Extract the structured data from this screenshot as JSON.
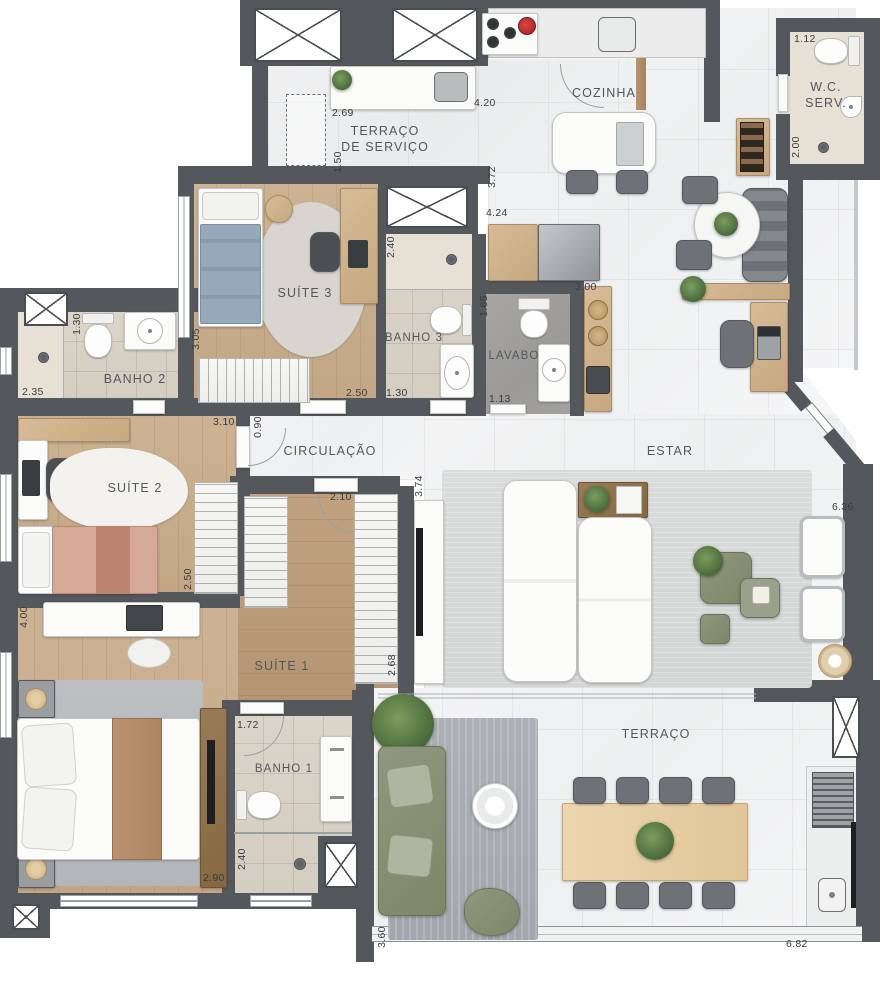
{
  "plan": {
    "type": "apartment-floor-plan",
    "rooms": {
      "terraco_servico": {
        "l1": "TERRAÇO",
        "l2": "DE SERVIÇO"
      },
      "cozinha": {
        "l1": "COZINHA"
      },
      "wc_serv": {
        "l1": "W.C.",
        "l2": "SERV."
      },
      "suite3": {
        "l1": "SUÍTE 3"
      },
      "banho3": {
        "l1": "BANHO 3"
      },
      "lavabo": {
        "l1": "LAVABO"
      },
      "banho2": {
        "l1": "BANHO 2"
      },
      "circulacao": {
        "l1": "CIRCULAÇÃO"
      },
      "estar": {
        "l1": "ESTAR"
      },
      "suite2": {
        "l1": "SUÍTE 2"
      },
      "suite1": {
        "l1": "SUÍTE 1"
      },
      "banho1": {
        "l1": "BANHO 1"
      },
      "terraco": {
        "l1": "TERRAÇO"
      }
    },
    "dims": [
      "2.69",
      "1.50",
      "4.20",
      "3.72",
      "4.24",
      "1.12",
      "2.00",
      "3.05",
      "2.50",
      "2.40",
      "1.30",
      "1.30",
      "2.35",
      "1.65",
      "1.13",
      "3.00",
      "0.90",
      "3.10",
      "2.50",
      "2.10",
      "2.68",
      "3.74",
      "6.36",
      "4.00",
      "2.90",
      "1.72",
      "2.40",
      "3.60",
      "6.82"
    ],
    "colors": {
      "wall": "#54575b",
      "marble_floor": "#f2f3f4",
      "wood_floor": "#c8ad8d",
      "tile_floor": "#d8d1c5",
      "stone_floor": "#a09f9d",
      "rug_living": "#d8dbda",
      "rug_terrace": "#a9aeb5",
      "sofa_green": "#87907a",
      "table_wood": "#d7bc97",
      "accent_bed_blue": "#95a9ba",
      "accent_bed_pink": "#d6a897",
      "accent_runner": "#b58d6b"
    }
  }
}
